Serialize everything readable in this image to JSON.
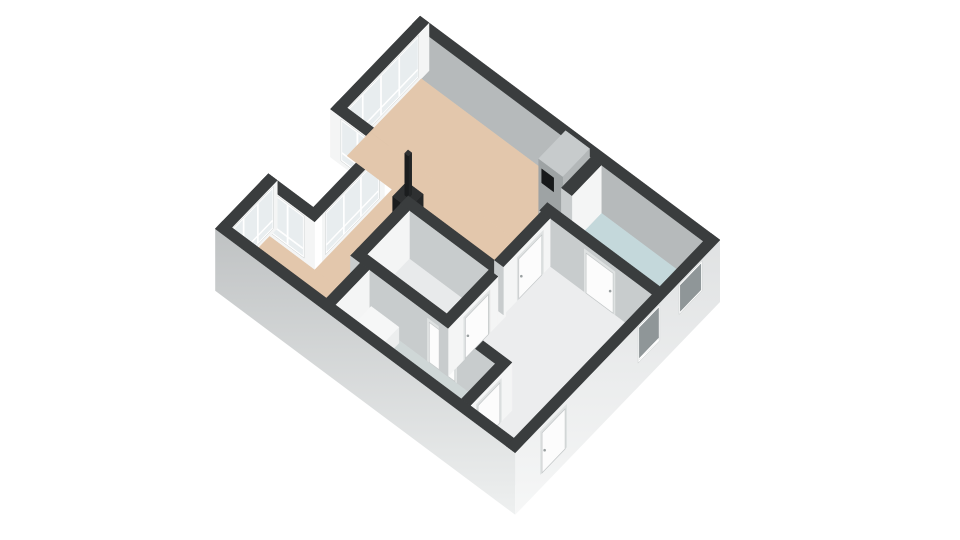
{
  "meta": {
    "description": "3D axonometric floor plan of an apartment on a white background"
  },
  "colors": {
    "bg": "#ffffff",
    "wallTop": "#3a3d3e",
    "innerGray": "#b6babb",
    "faceLight": "#f4f5f5",
    "faceShadow": "#c8cccd",
    "extLight": "#d2d4d5",
    "extLighter": "#e9eaeb",
    "glass": "#e8edef",
    "glassDark": "#8f9698",
    "frame": "#ffffff",
    "floorTan": "#e3c7ac",
    "floorBlue": "#c4d8db",
    "floorWhite": "#ecedee",
    "floorBedroom": "#e8eaeb",
    "floorGray": "#cfd7d7",
    "doorLeaf": "#fcfcfc",
    "doorFrame": "#dfe2e2",
    "doorStroke": "#c4c8c9",
    "handle": "#9aa0a1",
    "stoveTop": "#2e3031",
    "stoveSide": "#242627",
    "stoveSideDark": "#1a1c1d",
    "pipeTop": "#303233",
    "pipePA": "#232526",
    "pipePB": "#1b1d1e",
    "fridgeTop": "#c7cbcc",
    "fridgePA": "#b3b7b8",
    "fridgePB": "#9ea3a4",
    "panelBlack": "#17191a",
    "boxTop": "#f6f7f7",
    "boxPA": "#eceeee",
    "boxPB": "#dfe2e2"
  },
  "projection": {
    "ox": 420,
    "oy": 64,
    "ax": 0.75,
    "ay": 0.56,
    "bx": -0.64,
    "by": 0.665,
    "wall_height": 48,
    "ground_depth": 14
  },
  "exterior_walls": [
    {
      "name": "exterior-wall-northeast",
      "rect": [
        0,
        0,
        400,
        12
      ],
      "faces": [
        {
          "side": "+b",
          "color": "innerGray",
          "h0": 0
        }
      ]
    },
    {
      "name": "exterior-wall-northwest-upper",
      "rect": [
        0,
        0,
        12,
        140
      ],
      "faces": [
        {
          "side": "+a",
          "color": "faceLight",
          "h0": 0,
          "windows": [
            {
              "pos": [
                18,
                132
              ],
              "panes": 4
            }
          ]
        }
      ]
    },
    {
      "name": "loggia-wall-north",
      "rect": [
        0,
        128,
        72,
        140
      ],
      "faces": [
        {
          "side": "+b",
          "color": "faceLight",
          "h0": 0,
          "windows": [
            {
              "pos": [
                16,
                56
              ],
              "panes": 2
            }
          ]
        }
      ]
    },
    {
      "name": "loggia-wall-back",
      "rect": [
        60,
        140,
        72,
        237
      ],
      "faces": [
        {
          "side": "+a",
          "color": "faceLight",
          "h0": 0,
          "windows": [
            {
              "pos": [
                150,
                230
              ],
              "panes": 3
            }
          ]
        }
      ]
    },
    {
      "name": "loggia-wall-south",
      "rect": [
        0,
        237,
        72,
        249
      ],
      "faces": [
        {
          "side": "+b",
          "color": "faceLight",
          "h0": 0,
          "windows": [
            {
              "pos": [
                16,
                56
              ],
              "panes": 2
            }
          ]
        }
      ]
    },
    {
      "name": "exterior-wall-northwest-lower",
      "rect": [
        0,
        237,
        12,
        320
      ],
      "faces": [
        {
          "side": "+a",
          "color": "faceLight",
          "h0": 0,
          "windows": [
            {
              "pos": [
                245,
                312
              ],
              "panes": 3
            }
          ]
        }
      ]
    }
  ],
  "floors": [
    {
      "name": "floor-living-room",
      "color": "floorTan",
      "rects": [
        [
          12,
          12,
          252,
          92
        ],
        [
          12,
          92,
          72,
          128
        ],
        [
          72,
          92,
          240,
          165
        ],
        [
          72,
          165,
          125,
          255
        ],
        [
          12,
          249,
          138,
          308
        ]
      ]
    },
    {
      "name": "floor-bathroom",
      "color": "floorBlue",
      "rects": [
        [
          252,
          12,
          388,
          80
        ]
      ]
    },
    {
      "name": "floor-hallway",
      "color": "floorWhite",
      "rects": [
        [
          240,
          92,
          388,
          308
        ]
      ]
    },
    {
      "name": "floor-bedroom",
      "color": "floorBedroom",
      "rects": [
        [
          137,
          177,
          243,
          243
        ]
      ]
    },
    {
      "name": "floor-bathroom-2",
      "color": "floorGray",
      "rects": [
        [
          150,
          255,
          318,
          308
        ]
      ]
    }
  ],
  "interior_walls": [
    {
      "name": "interior-wall-kitchen-stub",
      "rect": [
        238,
        12,
        252,
        58
      ],
      "faces": [
        {
          "side": "+a",
          "color": "faceLight"
        },
        {
          "side": "+b",
          "color": "faceShadow"
        }
      ]
    },
    {
      "name": "interior-wall-bathroom-south",
      "rect": [
        238,
        80,
        388,
        92
      ],
      "faces": [
        {
          "side": "+b",
          "color": "faceShadow",
          "door": {
            "pos": [
              300,
              336
            ]
          }
        },
        {
          "side": "+a",
          "color": "faceLight"
        }
      ]
    },
    {
      "name": "interior-wall-hall-divider",
      "rect": [
        240,
        92,
        252,
        165
      ],
      "faces": [
        {
          "side": "+a",
          "color": "faceLight",
          "door": {
            "pos": [
              105,
              141
            ]
          }
        },
        {
          "side": "+b",
          "color": "faceShadow"
        }
      ]
    },
    {
      "name": "interior-wall-bedroom-north",
      "rect": [
        125,
        165,
        255,
        177
      ],
      "faces": [
        {
          "side": "+b",
          "color": "faceShadow"
        },
        {
          "side": "+a",
          "color": "faceLight"
        }
      ]
    },
    {
      "name": "interior-wall-bedroom-west",
      "rect": [
        125,
        177,
        137,
        255
      ],
      "faces": [
        {
          "side": "+a",
          "color": "faceLight"
        },
        {
          "side": "+b",
          "color": "faceShadow"
        }
      ]
    },
    {
      "name": "interior-wall-bedroom-east",
      "rect": [
        243,
        177,
        255,
        255
      ],
      "faces": [
        {
          "side": "+a",
          "color": "faceLight",
          "door": {
            "pos": [
              192,
              228
            ]
          }
        },
        {
          "side": "+b",
          "color": "faceShadow"
        }
      ]
    },
    {
      "name": "interior-wall-south-rooms",
      "rect": [
        125,
        243,
        330,
        255
      ],
      "faces": [
        {
          "side": "+b",
          "color": "faceShadow",
          "door": {
            "pos": [
              230,
              264
            ]
          }
        },
        {
          "side": "+a",
          "color": "faceLight"
        }
      ]
    },
    {
      "name": "interior-wall-partition-southwest",
      "rect": [
        138,
        255,
        150,
        308
      ],
      "faces": [
        {
          "side": "+a",
          "color": "faceLight"
        },
        {
          "side": "+b",
          "color": "faceShadow"
        }
      ]
    },
    {
      "name": "interior-wall-bathroom2-east",
      "rect": [
        318,
        255,
        330,
        308
      ],
      "faces": [
        {
          "side": "+a",
          "color": "faceLight",
          "door": {
            "pos": [
              262,
              296
            ]
          }
        },
        {
          "side": "+b",
          "color": "faceShadow"
        }
      ]
    }
  ],
  "objects": [
    {
      "name": "refrigerator-cabinet",
      "rect": [
        206,
        14,
        238,
        56
      ],
      "h": [
        0,
        58
      ],
      "colors": {
        "top": "fridgeTop",
        "pa": "fridgePA",
        "pb": "fridgePB"
      },
      "panel": {
        "face": "+b",
        "pos": [
          210,
          226
        ],
        "h": [
          36,
          50
        ],
        "color": "panelBlack"
      }
    },
    {
      "name": "stove",
      "rect": [
        106,
        145,
        128,
        167
      ],
      "h": [
        0,
        38
      ],
      "colors": {
        "top": "stoveTop",
        "pa": "stoveSide",
        "pb": "stoveSideDark"
      }
    },
    {
      "name": "stove-pipe",
      "rect": [
        114.5,
        153,
        119.5,
        158
      ],
      "h": [
        38,
        80
      ],
      "colors": {
        "top": "pipeTop",
        "pa": "pipePA",
        "pb": "pipePB"
      }
    },
    {
      "name": "bathroom2-low-cabinet",
      "rect": [
        155,
        258,
        192,
        288
      ],
      "h": [
        0,
        16
      ],
      "colors": {
        "top": "boxTop",
        "pa": "boxPA",
        "pb": "boxPB"
      }
    }
  ],
  "front_walls": [
    {
      "name": "exterior-wall-southwest",
      "rect": [
        0,
        308,
        400,
        320
      ],
      "faces": [
        {
          "side": "+b",
          "color": "extLight",
          "grad": "gradSW",
          "h0": -14
        }
      ]
    },
    {
      "name": "exterior-wall-southeast",
      "rect": [
        388,
        0,
        400,
        320
      ],
      "faces": [
        {
          "side": "+a",
          "color": "extLighter",
          "grad": "gradSE",
          "h0": -14,
          "windows": [
            {
              "pos": [
                30,
                62
              ],
              "panes": 1,
              "h": [
                18,
                44
              ],
              "glass": "glassDark"
            },
            {
              "pos": [
                96,
                126
              ],
              "panes": 1,
              "h": [
                12,
                44
              ],
              "glass": "glassDark"
            }
          ],
          "door": {
            "pos": [
              242,
              278
            ]
          }
        }
      ]
    }
  ]
}
